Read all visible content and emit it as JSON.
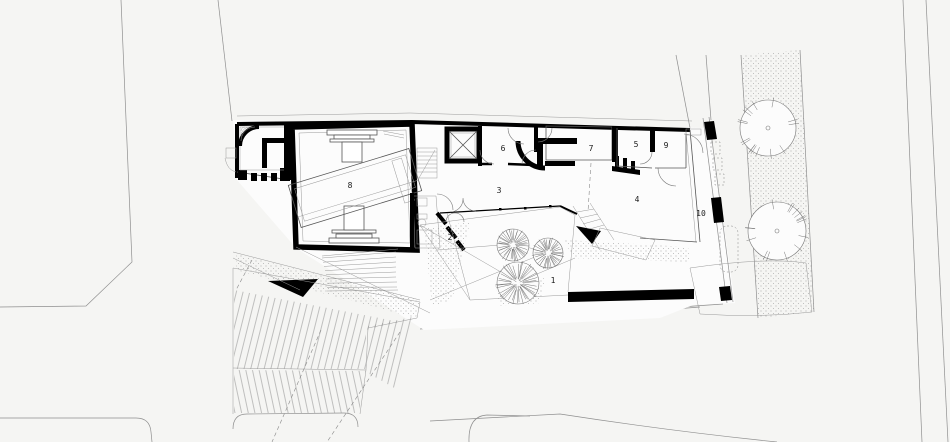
{
  "drawing": {
    "type": "architectural-site-plan",
    "colors": {
      "background": "#f5f5f3",
      "walls": "#000000",
      "street_lines": "#8f8f8f",
      "labels": "#1a1a1a"
    },
    "rooms": [
      {
        "number": "1"
      },
      {
        "number": "2"
      },
      {
        "number": "3"
      },
      {
        "number": "4"
      },
      {
        "number": "5"
      },
      {
        "number": "6"
      },
      {
        "number": "7"
      },
      {
        "number": "8"
      },
      {
        "number": "9"
      },
      {
        "number": "10"
      }
    ],
    "icons": {
      "tree": "tree-icon",
      "elevator": "elevator-x-icon",
      "stairs": "stairs-icon"
    }
  }
}
